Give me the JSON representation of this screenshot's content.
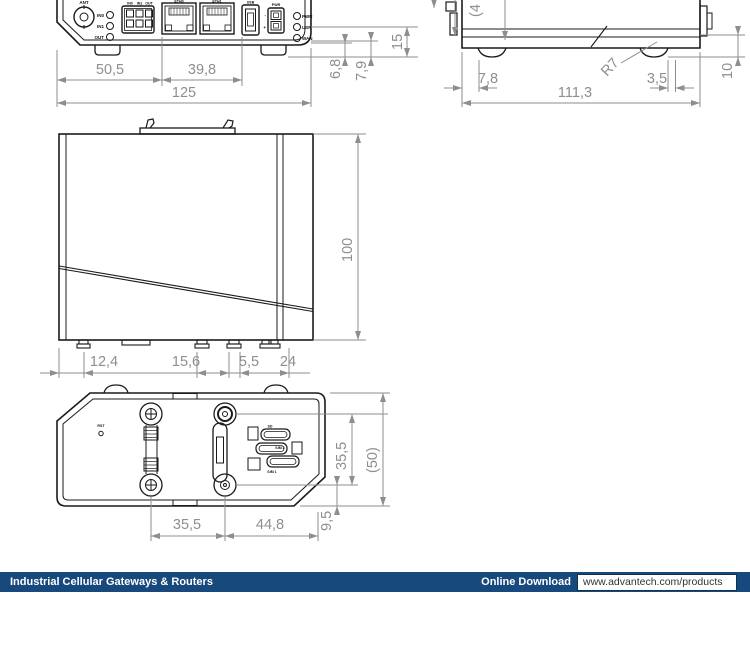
{
  "colors": {
    "outline": "#1a1a1a",
    "dimension": "#8e8e8e",
    "footer_bar": "#17497c",
    "footer_text": "#ffffff",
    "url_text": "#333333",
    "background": "#ffffff"
  },
  "front_view": {
    "dims": {
      "left_section": "50,5",
      "mid_section": "39,8",
      "total_width": "125",
      "height_a": "6,8",
      "height_b": "7,9",
      "height_c": "15"
    },
    "labels": {
      "ant": "ANT",
      "led_in0": "IN0",
      "led_in1": "IN1",
      "led_out": "OUT",
      "pin_in0": "IN0",
      "pin_in1": "IN1",
      "pin_out": "OUT",
      "eth0": "ETH0",
      "eth1": "ETH1",
      "usb": "USB",
      "pwr": "PWR",
      "minus": "-",
      "plus": "+",
      "led_pwr": "PWR",
      "led_usr": "USR",
      "led_wan": "WAN"
    }
  },
  "side_view": {
    "dims": {
      "partial": "(4",
      "foot_offset": "7,8",
      "corner_radius": "R7",
      "edge_offset": "3,5",
      "total_depth": "111,3",
      "bottom_height": "10"
    }
  },
  "top_view": {
    "dims": {
      "total_height": "100",
      "seg1": "12,4",
      "seg2": "15,6",
      "seg3": "5,5",
      "seg4": "24"
    }
  },
  "bottom_view": {
    "labels": {
      "rst": "RST",
      "sd": "SD",
      "sim2": "SIM 2",
      "sim1": "SIM 1"
    },
    "dims": {
      "screw_span_v": "35,5",
      "total_height": "(50)",
      "screw_span_h": "35,5",
      "screw_to_edge": "44,8",
      "edge_offset": "9,5"
    }
  },
  "footer": {
    "category": "Industrial Cellular Gateways & Routers",
    "download_label": "Online Download",
    "url": "www.advantech.com/products"
  }
}
